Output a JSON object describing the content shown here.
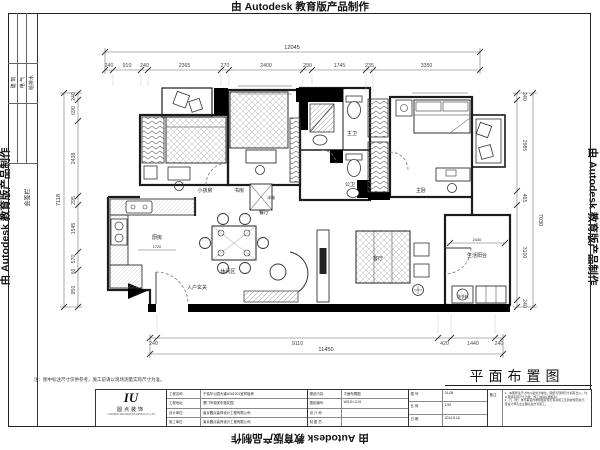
{
  "watermark": {
    "text": "由 Autodesk 教育版产品制作"
  },
  "sheet": {
    "title": "平面布置图",
    "note": "注：图中标注尺寸仅供参考，施工前请以现场测量实际尺寸为准。"
  },
  "signature": {
    "label": "会签栏",
    "cols": [
      "建 筑",
      "电 气",
      "给排水"
    ]
  },
  "rooms": {
    "kids": "小孩房",
    "study": "书房",
    "kitchen": "厨房",
    "dining": "餐厅",
    "leisure": "休闲区",
    "entry": "入户玄关",
    "living": "客厅",
    "balcony": "生活阳台",
    "bath_master": "主卫",
    "bath_guest": "公卫",
    "bed_master": "主卧",
    "fridge": "冰箱",
    "washer": "洗衣机"
  },
  "dims": {
    "top_total": "12045",
    "top": [
      "240",
      "910",
      "240",
      "2365",
      "270",
      "2400",
      "290",
      "1745",
      "235",
      "3350"
    ],
    "left_total": "7118",
    "left": [
      "240",
      "690",
      "2438",
      "295",
      "1545",
      "570",
      "60",
      "950"
    ],
    "right_total": "7030",
    "right": [
      "240",
      "2985",
      "465",
      "3100",
      "240"
    ],
    "bottom_total": "11450",
    "bottom": [
      "240",
      "9110",
      "420",
      "1440",
      "240"
    ],
    "kitchen_counter": "1720",
    "balcony_width": "2440"
  },
  "titleblock": {
    "logo_mark": "IU",
    "logo_name": "圆点装饰",
    "logo_sub": "YUANDIAN DECORATION DESIGN CO.,LTD",
    "fields": [
      {
        "label": "工程名称:",
        "value": "千禧华公园大道A2#1201室样板房"
      },
      {
        "label": "工程地址:",
        "value": "厦门市湖滨东路花园"
      },
      {
        "label": "设计单位:",
        "value": "南京圆点装饰设计工程有限公司"
      },
      {
        "label": "施工单位:",
        "value": "南京圆点装饰设计工程有限公司"
      }
    ],
    "drawing": [
      {
        "label": "图纸内容:",
        "value": "平面布置图"
      },
      {
        "label": "图纸编号:",
        "value": "WGJH-3-01"
      },
      {
        "label": "设 计 师:",
        "value": ""
      },
      {
        "label": "制 图 员:",
        "value": ""
      }
    ],
    "approval": [
      {
        "label": "图 号:",
        "value": "01-08"
      },
      {
        "label": "比 例:",
        "value": "1:50"
      },
      {
        "label": "日 期:",
        "value": "2014.5.16"
      }
    ],
    "remarks": {
      "label": "备注",
      "lines": [
        "1、本图所注尺寸均以毫米为单位，图纸与现场尺寸如有出入，均以现场实际尺寸为准，施工前请仔细核对。",
        "2、凡（含）未尽事宜均参照国家现行有关施工及验收规范执行，经设计师及业主确认后方可施工。"
      ]
    }
  }
}
